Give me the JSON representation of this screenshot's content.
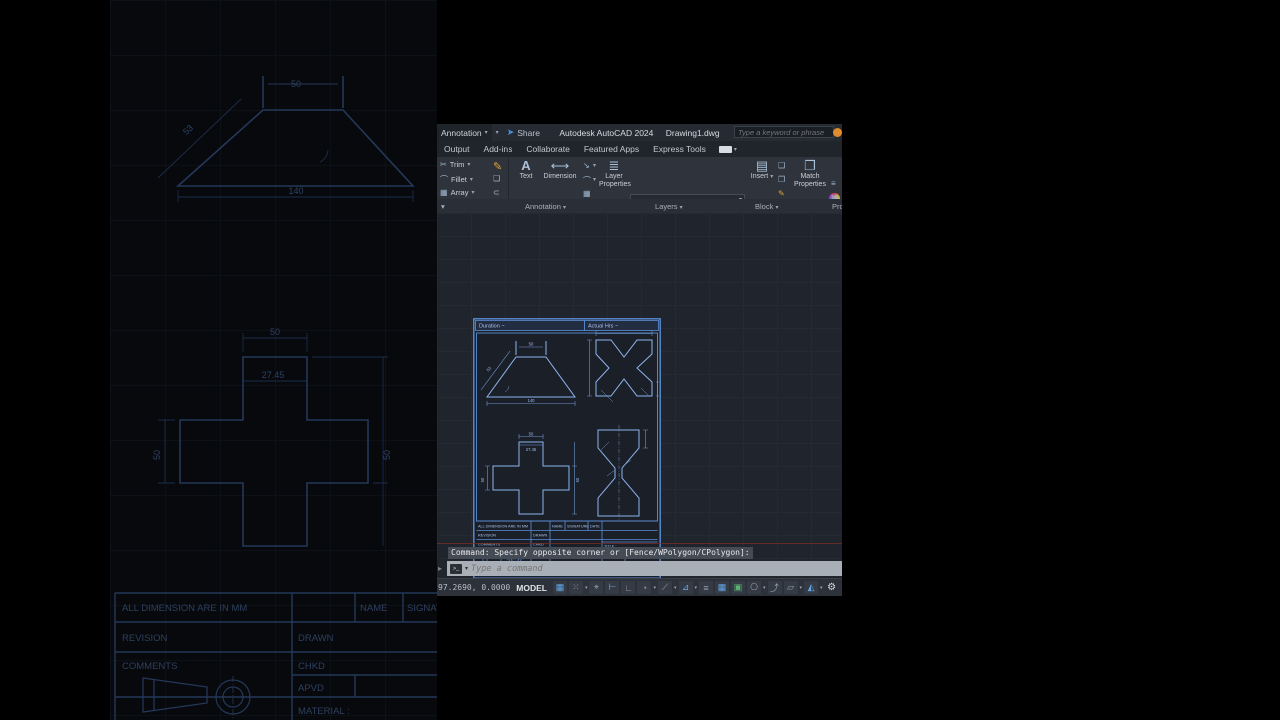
{
  "titlebar": {
    "workspace": "Annotation",
    "share": "Share",
    "app": "Autodesk AutoCAD 2024",
    "doc": "Drawing1.dwg",
    "search_placeholder": "Type a keyword or phrase"
  },
  "tabs": {
    "t0": "Output",
    "t1": "Add-ins",
    "t2": "Collaborate",
    "t3": "Featured Apps",
    "t4": "Express Tools"
  },
  "ribbon": {
    "trim": "Trim",
    "fillet": "Fillet",
    "array": "Array",
    "text": "Text",
    "dimension": "Dimension",
    "annotation_label": "Annotation",
    "layer_properties_1": "Layer",
    "layer_properties_2": "Properties",
    "layers_label": "Layers",
    "insert": "Insert",
    "block_label": "Block",
    "match_1": "Match",
    "match_2": "Properties",
    "properties_label": "Pro",
    "icons": {
      "caret": "▾",
      "scissors": "✂",
      "pencil": "✎",
      "fillet_arc": "⌒",
      "box3d": "❑",
      "array_grid": "▦",
      "clip": "⊂",
      "big_a": "A",
      "dim_icon": "⟷",
      "leader": "↘",
      "table": "▦",
      "layers_stack": "≣",
      "insert_block": "▤",
      "match_brush": "❐",
      "lines": "≡",
      "share_plane": "➤",
      "panel_expand": "▾",
      "ribbon_caret": "▾"
    }
  },
  "sheet": {
    "header_left": "Duration  ~",
    "header_right": "Actual Hrs  ~",
    "dims": {
      "trap_top": "50",
      "trap_slant": "53",
      "trap_bottom": "140",
      "cross_top": "50",
      "cross_inner": "27.45",
      "cross_left": "50",
      "cross_right": "50"
    },
    "tb": {
      "all_dim": "ALL DIMENSION ARE IN MM",
      "name": "NAME",
      "signature": "SIGNATURE",
      "date": "DATE",
      "revision": "REVISION",
      "drawn": "DRAWN",
      "comments": "COMMENTS",
      "chkd": "CHKD",
      "apvd": "APVD",
      "material": "MATERIAL :",
      "title": "TITLE :",
      "scale": "SCALE 1:1",
      "sheet_of": "SHEET 1 OF 1"
    },
    "footer": {
      "f0": "DEDICATED",
      "f1": "DETERMINED",
      "f2": "DYNAMIC",
      "f3": "DESERVING"
    }
  },
  "command": {
    "history": "Command: Specify opposite corner or [Fence/WPolygon/CPolygon]:",
    "placeholder": "Type a command",
    "prompt_glyph": ">_",
    "left_arrow": "▸",
    "caret": "▾"
  },
  "status": {
    "coords": "97.2690, 0.0000",
    "model": "MODEL",
    "caret": "▾",
    "icons": [
      {
        "n": "grid-icon",
        "g": "▦"
      },
      {
        "n": "snap-icon",
        "g": "⁙"
      },
      {
        "n": "dynamic-input-icon",
        "g": "⌖"
      },
      {
        "n": "ortho-icon",
        "g": "⊢"
      },
      {
        "n": "polar-tracking-icon",
        "g": "∟"
      },
      {
        "n": "isodraft-icon",
        "g": "◔"
      },
      {
        "n": "osnap-tracking-icon",
        "g": "⟋"
      },
      {
        "n": "object-snap-icon",
        "g": "⊿"
      },
      {
        "n": "lineweight-icon",
        "g": "≡"
      },
      {
        "n": "transparency-icon",
        "g": "▦"
      },
      {
        "n": "selection-cycling-icon",
        "g": "▣"
      },
      {
        "n": "osnap-3d-icon",
        "g": "⎔"
      },
      {
        "n": "dynamic-ucs-icon",
        "g": "⤴"
      },
      {
        "n": "annotation-scale-icon",
        "g": "▱"
      },
      {
        "n": "annotation-visibility-icon",
        "g": "◭"
      },
      {
        "n": "isolate-objects-icon",
        "g": "⚙"
      },
      {
        "n": "customization-icon",
        "g": "✦"
      }
    ]
  }
}
